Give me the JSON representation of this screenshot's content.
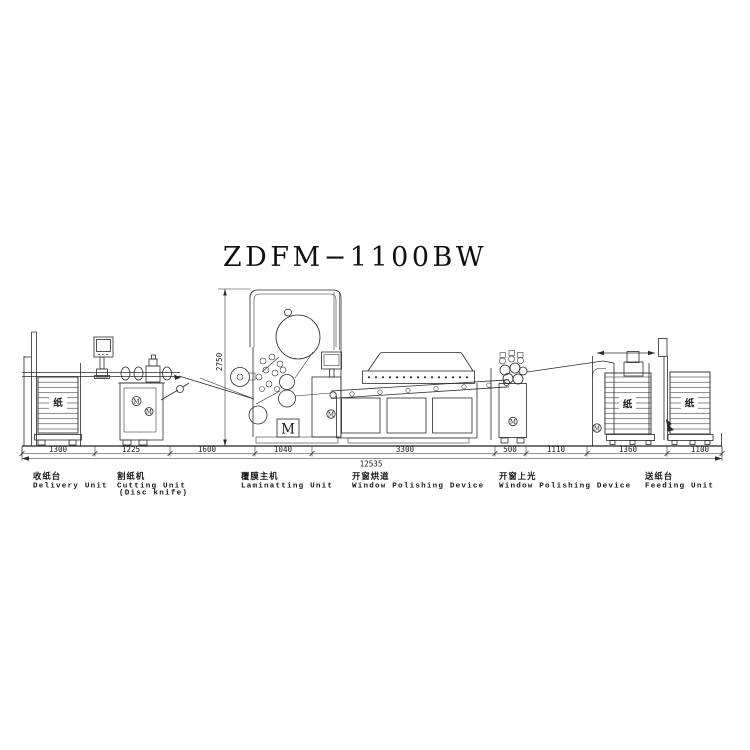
{
  "title": "ZDFM−1100BW",
  "dims": {
    "segments": [
      "1300",
      "1225",
      "1600",
      "1040",
      "3300",
      "500",
      "1110",
      "1360",
      "1100"
    ],
    "overall": "12535",
    "height": "2750"
  },
  "units": [
    {
      "zh": "收纸台",
      "en": "Delivery Unit",
      "en2": ""
    },
    {
      "zh": "割纸机",
      "en": "Cutting Unit",
      "en2": "(Disc knife)"
    },
    {
      "zh": "覆膜主机",
      "en": "Laminatting Unit",
      "en2": ""
    },
    {
      "zh": "开窗烘道",
      "en": "Window Polishing Device",
      "en2": ""
    },
    {
      "zh": "开窗上光",
      "en": "Window Polishing Device",
      "en2": ""
    },
    {
      "zh": "送纸台",
      "en": "Feeding Unit",
      "en2": ""
    }
  ],
  "symbols": {
    "paper": "纸",
    "motor": "M"
  },
  "colors": {
    "line": "#2b2b2b",
    "background": "#ffffff"
  }
}
